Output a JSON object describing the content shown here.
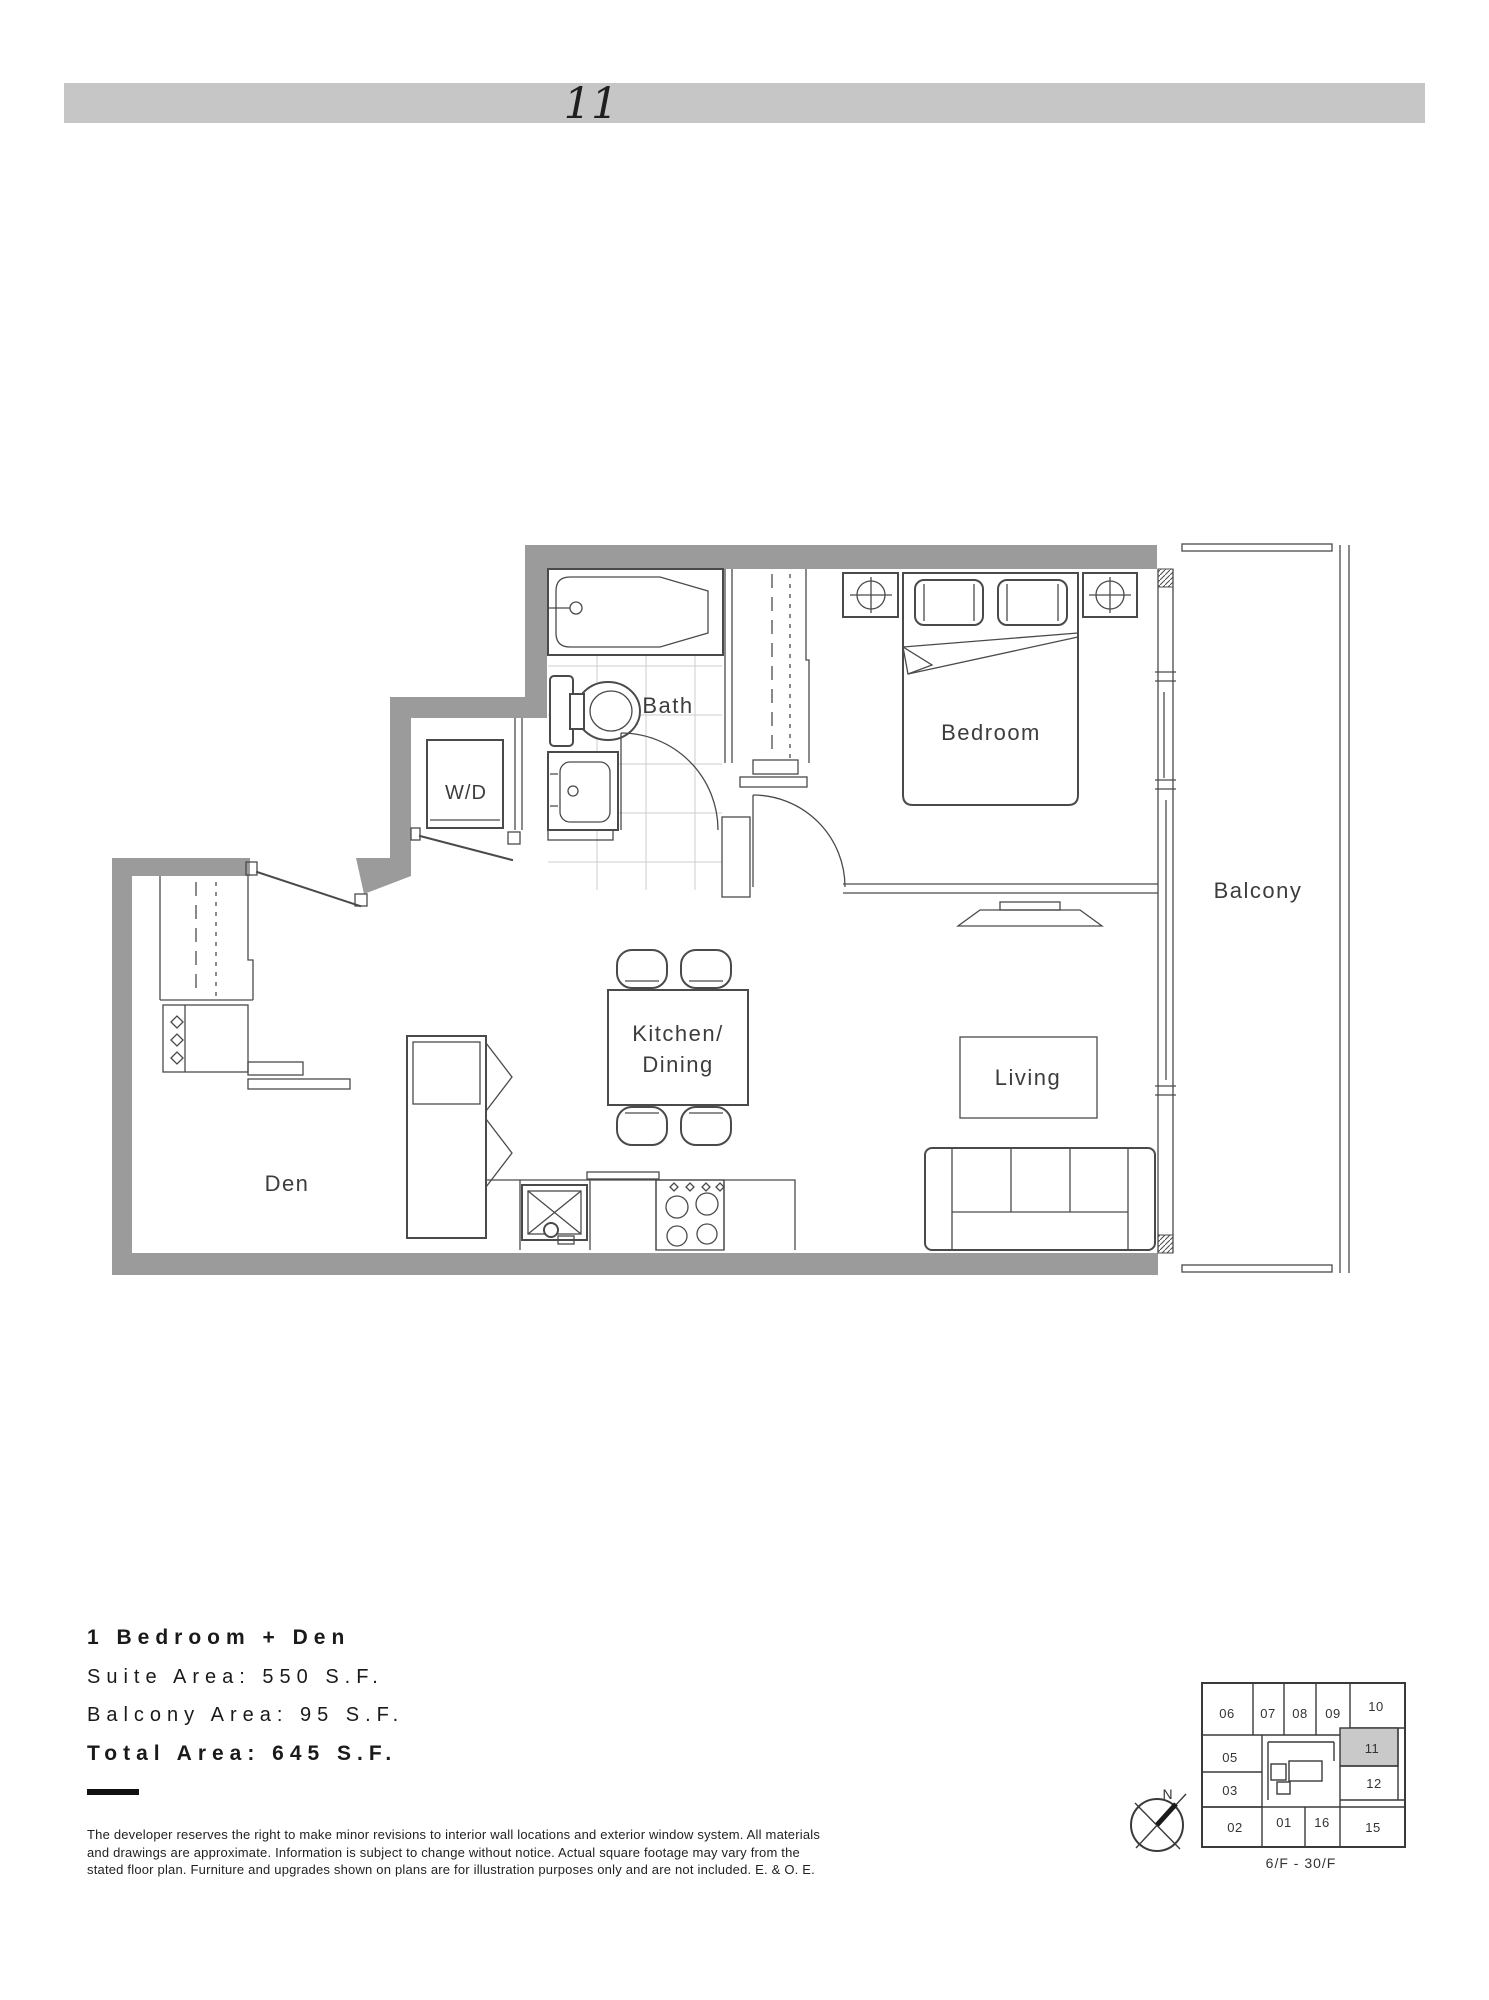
{
  "header": {
    "unit_number": "11"
  },
  "colors": {
    "wall": "#9b9b9b",
    "header_bar": "#c6c6c6",
    "line": "#4a4a4a",
    "tile": "#cccccc",
    "keyplan_highlight": "#c9c9c9"
  },
  "plan": {
    "rooms": {
      "bath": "Bath",
      "wd": "W/D",
      "bedroom": "Bedroom",
      "balcony": "Balcony",
      "kitchen_line1": "Kitchen/",
      "kitchen_line2": "Dining",
      "living": "Living",
      "den": "Den"
    }
  },
  "info": {
    "plan_type": "1 Bedroom + Den",
    "suite_area": "Suite Area: 550 S.F.",
    "balcony_area": "Balcony Area: 95 S.F.",
    "total_area": "Total Area: 645 S.F.",
    "disclaimer": [
      "The developer reserves the right to make minor revisions to interior wall locations and exterior window system. All materials",
      "and drawings are approximate. Information is subject to change without notice. Actual square footage may vary from the",
      "stated floor plan. Furniture and upgrades shown on plans are for illustration purposes only and are not included. E. & O. E."
    ]
  },
  "keyplan": {
    "units": [
      "06",
      "07",
      "08",
      "09",
      "10",
      "05",
      "11",
      "03",
      "12",
      "02",
      "01",
      "16",
      "15"
    ],
    "highlighted_unit": "11",
    "floor_range": "6/F - 30/F",
    "north_label": "N"
  }
}
